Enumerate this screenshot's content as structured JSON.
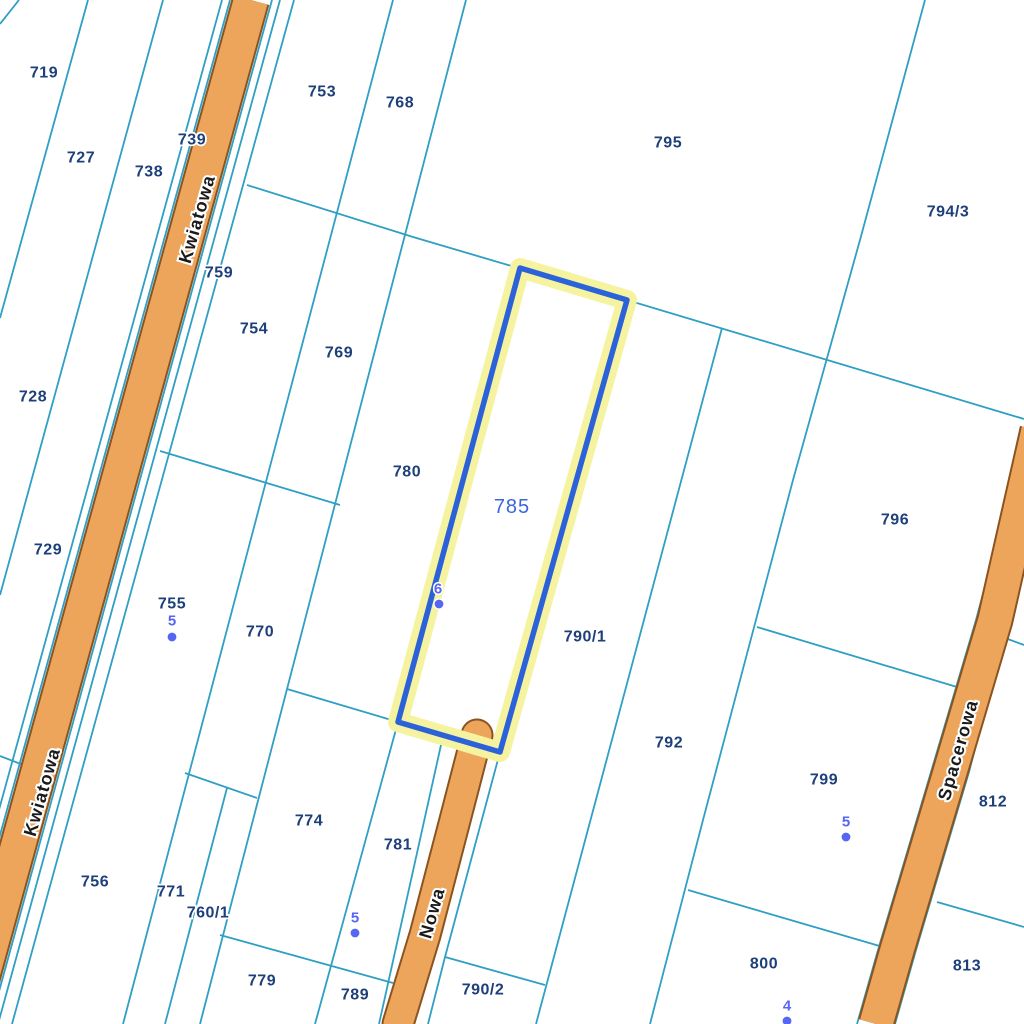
{
  "map": {
    "colors": {
      "background": "#ffffff",
      "boundary_line": "#2f9fc3",
      "road_fill": "#eda55c",
      "road_edge": "#8a5420",
      "parcel_label": "#1d3f7a",
      "street_label": "#1a1a1a",
      "selected_outline": "#2b62d9",
      "selected_halo": "#f6f3a0",
      "selected_label": "#3c66db",
      "address_point": "#5765f5"
    },
    "selected_parcel": {
      "label": "785",
      "label_x": 512,
      "label_y": 507,
      "polygon": [
        [
          520,
          268
        ],
        [
          627,
          300
        ],
        [
          500,
          752
        ],
        [
          398,
          722
        ]
      ]
    },
    "parcel_labels": [
      {
        "id": "719",
        "x": 44,
        "y": 73
      },
      {
        "id": "727",
        "x": 81,
        "y": 158
      },
      {
        "id": "738",
        "x": 149,
        "y": 172
      },
      {
        "id": "739",
        "x": 192,
        "y": 140
      },
      {
        "id": "753",
        "x": 322,
        "y": 92
      },
      {
        "id": "768",
        "x": 400,
        "y": 103
      },
      {
        "id": "795",
        "x": 668,
        "y": 143
      },
      {
        "id": "794/3",
        "x": 948,
        "y": 212
      },
      {
        "id": "759",
        "x": 219,
        "y": 273
      },
      {
        "id": "754",
        "x": 254,
        "y": 329
      },
      {
        "id": "769",
        "x": 339,
        "y": 353
      },
      {
        "id": "728",
        "x": 33,
        "y": 397
      },
      {
        "id": "780",
        "x": 407,
        "y": 472
      },
      {
        "id": "796",
        "x": 895,
        "y": 520
      },
      {
        "id": "729",
        "x": 48,
        "y": 550
      },
      {
        "id": "755",
        "x": 172,
        "y": 604
      },
      {
        "id": "770",
        "x": 260,
        "y": 632
      },
      {
        "id": "790/1",
        "x": 585,
        "y": 637
      },
      {
        "id": "792",
        "x": 669,
        "y": 743
      },
      {
        "id": "799",
        "x": 824,
        "y": 780
      },
      {
        "id": "812",
        "x": 993,
        "y": 802
      },
      {
        "id": "774",
        "x": 309,
        "y": 821
      },
      {
        "id": "781",
        "x": 398,
        "y": 845
      },
      {
        "id": "756",
        "x": 95,
        "y": 882
      },
      {
        "id": "771",
        "x": 171,
        "y": 892
      },
      {
        "id": "760/1",
        "x": 208,
        "y": 913
      },
      {
        "id": "800",
        "x": 764,
        "y": 964
      },
      {
        "id": "813",
        "x": 967,
        "y": 966
      },
      {
        "id": "779",
        "x": 262,
        "y": 981
      },
      {
        "id": "789",
        "x": 355,
        "y": 995
      },
      {
        "id": "790/2",
        "x": 483,
        "y": 990
      }
    ],
    "street_labels": [
      {
        "text": "Kwiatowa",
        "x": 197,
        "y": 219,
        "rotation": -74
      },
      {
        "text": "Kwiatowa",
        "x": 42,
        "y": 792,
        "rotation": -74
      },
      {
        "text": "Nowa",
        "x": 432,
        "y": 913,
        "rotation": -74
      },
      {
        "text": "Spacerowa",
        "x": 958,
        "y": 750,
        "rotation": -74
      }
    ],
    "address_points": [
      {
        "number": "5",
        "x": 172,
        "y": 621,
        "dot_x": 172,
        "dot_y": 637
      },
      {
        "number": "6",
        "x": 438,
        "y": 589,
        "dot_x": 439,
        "dot_y": 604
      },
      {
        "number": "5",
        "x": 355,
        "y": 918,
        "dot_x": 355,
        "dot_y": 933
      },
      {
        "number": "5",
        "x": 846,
        "y": 822,
        "dot_x": 846,
        "dot_y": 837
      },
      {
        "number": "4",
        "x": 787,
        "y": 1006,
        "dot_x": 787,
        "dot_y": 1021
      }
    ],
    "roads": [
      {
        "name": "Kwiatowa",
        "width": 34,
        "cap": "butt",
        "centerline": [
          [
            251,
            0
          ],
          [
            -31,
            1024
          ]
        ]
      },
      {
        "name": "Nowa",
        "width": 29,
        "cap": "round",
        "centerline": [
          [
            477,
            735
          ],
          [
            455,
            820
          ],
          [
            425,
            935
          ],
          [
            398,
            1024
          ]
        ]
      },
      {
        "name": "Spacerowa",
        "width": 33,
        "cap": "butt",
        "centerline": [
          [
            1038,
            430
          ],
          [
            995,
            620
          ],
          [
            950,
            772
          ],
          [
            897,
            950
          ],
          [
            876,
            1024
          ]
        ]
      }
    ],
    "boundaries": [
      {
        "points": [
          [
            19,
            0
          ],
          [
            0,
            24
          ]
        ]
      },
      {
        "points": [
          [
            88,
            0
          ],
          [
            0,
            318
          ]
        ]
      },
      {
        "points": [
          [
            163,
            0
          ],
          [
            0,
            595
          ]
        ]
      },
      {
        "points": [
          [
            222,
            0
          ],
          [
            -60,
            1024
          ]
        ]
      },
      {
        "points": [
          [
            230,
            0
          ],
          [
            -52,
            1024
          ]
        ]
      },
      {
        "points": [
          [
            272,
            0
          ],
          [
            -10,
            1024
          ]
        ]
      },
      {
        "points": [
          [
            280,
            0
          ],
          [
            -2,
            1024
          ]
        ]
      },
      {
        "points": [
          [
            294,
            0
          ],
          [
            12,
            1024
          ]
        ]
      },
      {
        "points": [
          [
            393,
            0
          ],
          [
            123,
            1024
          ]
        ]
      },
      {
        "points": [
          [
            466,
            0
          ],
          [
            200,
            1024
          ]
        ]
      },
      {
        "points": [
          [
            227,
            788
          ],
          [
            165,
            1024
          ]
        ]
      },
      {
        "points": [
          [
            398,
            722
          ],
          [
            315,
            1024
          ]
        ]
      },
      {
        "points": [
          [
            722,
            328
          ],
          [
            536,
            1024
          ]
        ]
      },
      {
        "points": [
          [
            925,
            0
          ],
          [
            860,
            240
          ],
          [
            793,
            480
          ],
          [
            703,
            820
          ],
          [
            650,
            1024
          ]
        ]
      },
      {
        "points": [
          [
            500,
            752
          ],
          [
            445,
            957
          ],
          [
            428,
            1024
          ]
        ]
      },
      {
        "points": [
          [
            443,
            736
          ],
          [
            379,
            1024
          ]
        ]
      },
      {
        "points": [
          [
            1024,
            440
          ],
          [
            976,
            620
          ],
          [
            931,
            772
          ],
          [
            878,
            950
          ],
          [
            857,
            1024
          ]
        ]
      },
      {
        "points": [
          [
            1024,
            560
          ],
          [
            969,
            772
          ],
          [
            916,
            950
          ],
          [
            895,
            1024
          ]
        ]
      },
      {
        "points": [
          [
            247,
            185
          ],
          [
            413,
            237
          ],
          [
            627,
            300
          ],
          [
            1024,
            419
          ]
        ]
      },
      {
        "points": [
          [
            160,
            451
          ],
          [
            340,
            505
          ]
        ]
      },
      {
        "points": [
          [
            287,
            689
          ],
          [
            398,
            722
          ]
        ]
      },
      {
        "points": [
          [
            185,
            773
          ],
          [
            257,
            798
          ]
        ]
      },
      {
        "points": [
          [
            220,
            935
          ],
          [
            393,
            983
          ]
        ]
      },
      {
        "points": [
          [
            445,
            957
          ],
          [
            545,
            985
          ]
        ]
      },
      {
        "points": [
          [
            0,
            756
          ],
          [
            26,
            766
          ]
        ]
      },
      {
        "points": [
          [
            757,
            627
          ],
          [
            957,
            687
          ]
        ]
      },
      {
        "points": [
          [
            688,
            890
          ],
          [
            883,
            947
          ]
        ]
      },
      {
        "points": [
          [
            937,
            902
          ],
          [
            1024,
            927
          ]
        ]
      },
      {
        "points": [
          [
            1005,
            638
          ],
          [
            1024,
            645
          ]
        ]
      }
    ]
  }
}
